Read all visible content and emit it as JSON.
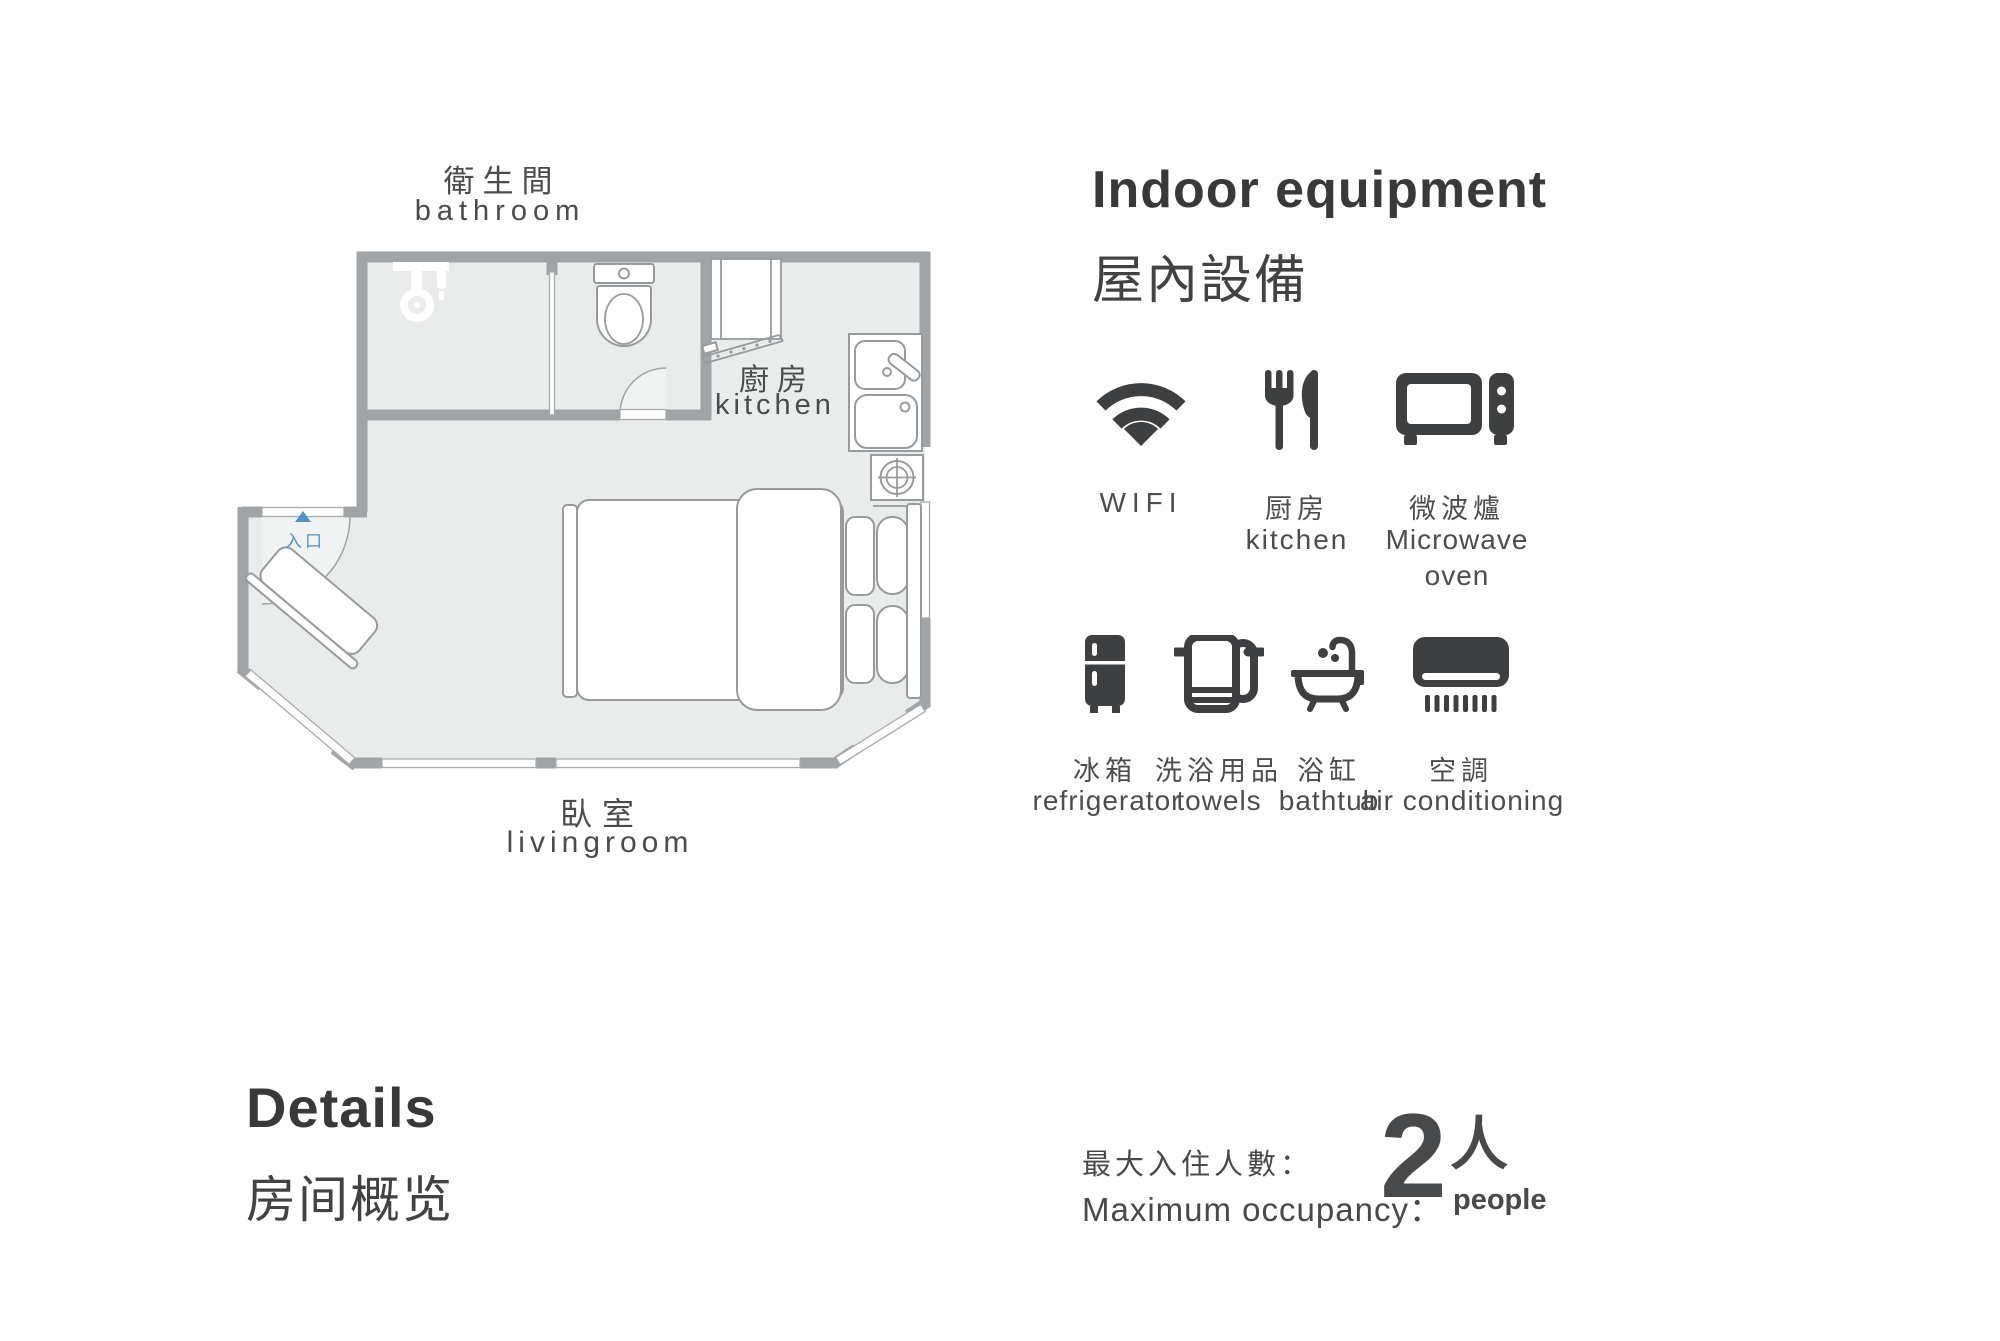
{
  "plan": {
    "bathroom_zh": "衛生間",
    "bathroom_en": "bathroom",
    "kitchen_zh": "廚房",
    "kitchen_en": "kitchen",
    "livingroom_zh": "臥室",
    "livingroom_en": "livingroom",
    "entrance_zh": "入口"
  },
  "equipment": {
    "title_en": "Indoor equipment",
    "title_zh": "屋內設備",
    "row1": [
      {
        "icon": "wifi-icon",
        "label1": "WIFI",
        "label2": ""
      },
      {
        "icon": "kitchen-icon",
        "label1": "厨房",
        "label2": "kitchen"
      },
      {
        "icon": "microwave-icon",
        "label1": "微波爐",
        "label2": "Microwave",
        "label3": "oven"
      }
    ],
    "row2": [
      {
        "icon": "refrigerator-icon",
        "label1": "冰箱",
        "label2": "refrigerator"
      },
      {
        "icon": "towels-icon",
        "label1": "洗浴用品",
        "label2": "towels"
      },
      {
        "icon": "bathtub-icon",
        "label1": "浴缸",
        "label2": "bathtub"
      },
      {
        "icon": "air-conditioning-icon",
        "label1": "空調",
        "label2": "air conditioning"
      }
    ]
  },
  "details": {
    "title_en": "Details",
    "title_zh": "房间概览"
  },
  "occupancy": {
    "label_zh": "最大入住人數：",
    "label_en": "Maximum occupancy：",
    "count": "2",
    "unit_zh": "人",
    "unit_en": "people"
  },
  "colors": {
    "icon_ink": "#3e3f41",
    "wall_gray": "#a1a4a6",
    "floor_gray": "#e9eceb",
    "entrance_blue": "#4f93c6"
  }
}
